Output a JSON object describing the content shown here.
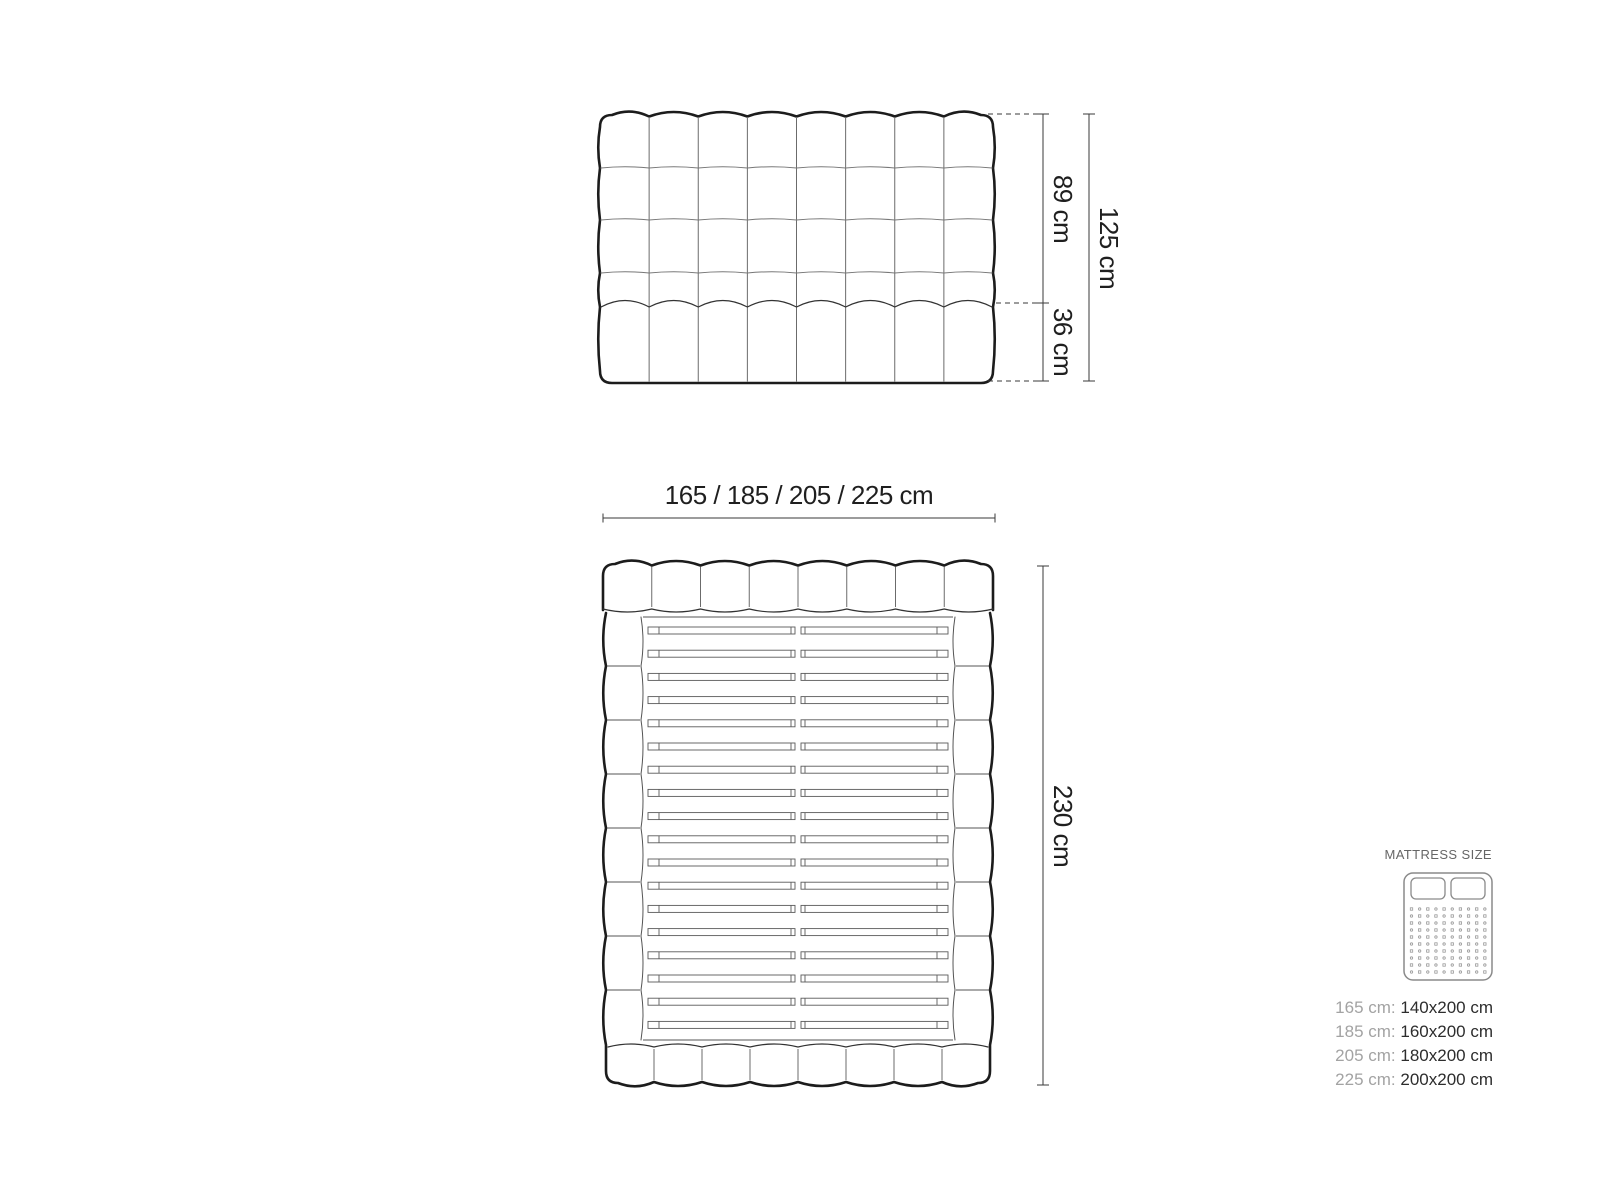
{
  "page": {
    "title": "Bed dimensions technical drawing",
    "background": "#ffffff"
  },
  "front_view": {
    "name": "headboard front view",
    "grid_columns": 8,
    "grid_rows": 4,
    "dim_upper": "89 cm",
    "dim_lower": "36 cm",
    "dim_total": "125 cm"
  },
  "top_view": {
    "name": "bed top view with slats",
    "slat_count": 18,
    "side_rail_cells": 8,
    "dim_width": "165 / 185 / 205 / 225 cm",
    "dim_length": "230 cm"
  },
  "legend": {
    "title": "MATTRESS SIZE",
    "rows": [
      {
        "frame_width": "165 cm:",
        "mattress_size": "140x200 cm"
      },
      {
        "frame_width": "185 cm:",
        "mattress_size": "160x200 cm"
      },
      {
        "frame_width": "205 cm:",
        "mattress_size": "180x200 cm"
      },
      {
        "frame_width": "225 cm:",
        "mattress_size": "200x200 cm"
      }
    ]
  },
  "colors": {
    "outline": "#1c1c1c",
    "inner_line": "#333333",
    "grid_line": "#6b6b6b",
    "slat_line": "#5a5a5a",
    "dim_line": "#3a3a3a",
    "label_text": "#1f1f1f",
    "legend_muted": "#a3a3a3",
    "legend_strong": "#2d2d2d",
    "icon_stroke": "#8a8a8a"
  }
}
